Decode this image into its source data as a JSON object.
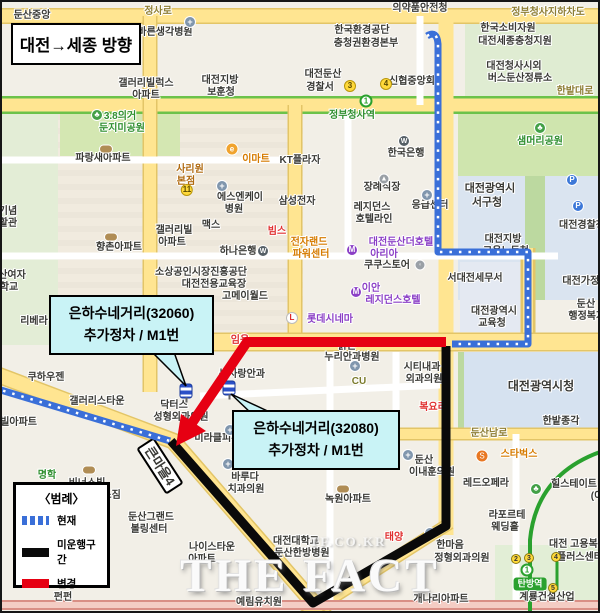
{
  "title_box": {
    "text": "대전→세종 방향"
  },
  "legend": {
    "title": "〈범례〉",
    "items": [
      {
        "label": "현재",
        "color": "#3a6fd8",
        "style": "dashed"
      },
      {
        "label": "미운행구간",
        "color": "#0a0a0a",
        "style": "solid"
      },
      {
        "label": "변경",
        "color": "#e60012",
        "style": "solid"
      }
    ]
  },
  "callouts": [
    {
      "line1": "은하수네거리(32060)",
      "line2": "추가정차 / M1번"
    },
    {
      "line1": "은하수네거리(32080)",
      "line2": "추가정차 / M1번"
    }
  ],
  "watermark": {
    "main": "THE FACT",
    "sub": "TF.CO.KR"
  },
  "routes": {
    "current_color": "#3a6fd8",
    "discontinued_color": "#0a0a0a",
    "changed_color": "#e60012"
  },
  "map": {
    "labels": [
      {
        "t": "둔산중앙",
        "x": 32,
        "y": 16,
        "w": 700
      },
      {
        "t": "정사로",
        "x": 158,
        "y": 12,
        "c": "#8d7d33"
      },
      {
        "t": "의약품안전청",
        "x": 420,
        "y": 9,
        "w": 700
      },
      {
        "t": "정부청사지하차도",
        "x": 548,
        "y": 13,
        "c": "#8d7d33"
      },
      {
        "t": "바른생각병원",
        "x": 165,
        "y": 33
      },
      {
        "t": "한국환경공단",
        "x": 362,
        "y": 31
      },
      {
        "t": "충청권환경본부",
        "x": 366,
        "y": 44
      },
      {
        "t": "한국소비자원",
        "x": 508,
        "y": 29
      },
      {
        "t": "대전세종충청지원",
        "x": 515,
        "y": 42
      },
      {
        "t": "갤러리빌럭스",
        "x": 146,
        "y": 84
      },
      {
        "t": "아파트",
        "x": 146,
        "y": 96
      },
      {
        "t": "대전지방",
        "x": 220,
        "y": 81
      },
      {
        "t": "보훈청",
        "x": 221,
        "y": 93
      },
      {
        "t": "대전둔산",
        "x": 323,
        "y": 75
      },
      {
        "t": "경찰서",
        "x": 320,
        "y": 88
      },
      {
        "t": "신협중앙회",
        "x": 412,
        "y": 82
      },
      {
        "t": "대전청사시외",
        "x": 514,
        "y": 67
      },
      {
        "t": "버스둔산정류소",
        "x": 520,
        "y": 79
      },
      {
        "t": "한밭대로",
        "x": 575,
        "y": 92,
        "c": "#8d7d33"
      },
      {
        "t": "정부청사역",
        "x": 352,
        "y": 116,
        "c": "#2f8f2f",
        "w": 700
      },
      {
        "t": "3.8의거",
        "x": 120,
        "y": 117,
        "c": "#2f8f2f"
      },
      {
        "t": "둔지미공원",
        "x": 122,
        "y": 129,
        "c": "#2f8f2f"
      },
      {
        "t": "샘머리공원",
        "x": 540,
        "y": 142,
        "c": "#2f8f2f"
      },
      {
        "t": "파랑새아파트",
        "x": 103,
        "y": 159
      },
      {
        "t": "사리원",
        "x": 190,
        "y": 170,
        "c": "#b06a10",
        "w": 700
      },
      {
        "t": "본점",
        "x": 186,
        "y": 182,
        "c": "#b06a10",
        "w": 700
      },
      {
        "t": "이마트",
        "x": 256,
        "y": 160,
        "c": "#d67b00",
        "w": 700
      },
      {
        "t": "KT플라자",
        "x": 300,
        "y": 161
      },
      {
        "t": "한국은행",
        "x": 406,
        "y": 154
      },
      {
        "t": "에스엔케이",
        "x": 240,
        "y": 198
      },
      {
        "t": "병원",
        "x": 234,
        "y": 210
      },
      {
        "t": "삼성전자",
        "x": 297,
        "y": 202
      },
      {
        "t": "빔스",
        "x": 277,
        "y": 232,
        "c": "#e03030",
        "w": 700
      },
      {
        "t": "장례식장",
        "x": 382,
        "y": 188
      },
      {
        "t": "레지던스",
        "x": 372,
        "y": 208
      },
      {
        "t": "호텔라인",
        "x": 374,
        "y": 220
      },
      {
        "t": "응급센터",
        "x": 430,
        "y": 206
      },
      {
        "t": "대전광역시",
        "x": 490,
        "y": 189,
        "s": 11
      },
      {
        "t": "서구청",
        "x": 487,
        "y": 203,
        "s": 11
      },
      {
        "t": "맥스",
        "x": 211,
        "y": 226
      },
      {
        "t": "갤러리빌",
        "x": 174,
        "y": 231
      },
      {
        "t": "아파트",
        "x": 172,
        "y": 243
      },
      {
        "t": "향촌아파트",
        "x": 119,
        "y": 248
      },
      {
        "t": "하나은행",
        "x": 238,
        "y": 252
      },
      {
        "t": "대전경찰청",
        "x": 582,
        "y": 226
      },
      {
        "t": "대전지방",
        "x": 503,
        "y": 240
      },
      {
        "t": "고용노동청",
        "x": 506,
        "y": 252
      },
      {
        "t": "전자랜드",
        "x": 309,
        "y": 243,
        "c": "#d67b00"
      },
      {
        "t": "파워센터",
        "x": 311,
        "y": 255,
        "c": "#d67b00"
      },
      {
        "t": "대전둔산더호텔",
        "x": 401,
        "y": 243,
        "c": "#8b3fc6"
      },
      {
        "t": "아리아",
        "x": 384,
        "y": 255,
        "c": "#8b3fc6"
      },
      {
        "t": "쿠쿠스토어",
        "x": 387,
        "y": 266
      },
      {
        "t": "소상공인시장진흥공단",
        "x": 201,
        "y": 273
      },
      {
        "t": "대전전용교육장",
        "x": 214,
        "y": 285
      },
      {
        "t": "고메이월드",
        "x": 245,
        "y": 297
      },
      {
        "t": "서대전세무서",
        "x": 475,
        "y": 279
      },
      {
        "t": "대전가정법원",
        "x": 590,
        "y": 282
      },
      {
        "t": "이안",
        "x": 371,
        "y": 289,
        "c": "#8b3fc6"
      },
      {
        "t": "레지던스호텔",
        "x": 393,
        "y": 301,
        "c": "#8b3fc6"
      },
      {
        "t": "둔산",
        "x": 586,
        "y": 305
      },
      {
        "t": "행정복지센터",
        "x": 596,
        "y": 317
      },
      {
        "t": "대전광역시",
        "x": 494,
        "y": 312
      },
      {
        "t": "교육청",
        "x": 492,
        "y": 324
      },
      {
        "t": "리베라",
        "x": 34,
        "y": 322
      },
      {
        "t": "롯데시네마",
        "x": 330,
        "y": 320,
        "c": "#8b3fc6"
      },
      {
        "t": "맑은",
        "x": 347,
        "y": 347
      },
      {
        "t": "누리안과병원",
        "x": 352,
        "y": 358
      },
      {
        "t": "시티내과",
        "x": 422,
        "y": 368
      },
      {
        "t": "외과의원",
        "x": 424,
        "y": 380
      },
      {
        "t": "CU",
        "x": 359,
        "y": 382,
        "c": "#7a7a2a",
        "w": 700
      },
      {
        "t": "대전광역시청",
        "x": 541,
        "y": 386,
        "s": 12,
        "w": 700
      },
      {
        "t": "눈사랑안과",
        "x": 242,
        "y": 375
      },
      {
        "t": "쿠하우젠",
        "x": 46,
        "y": 378
      },
      {
        "t": "임용",
        "x": 240,
        "y": 341,
        "c": "#e03030"
      },
      {
        "t": "복요리",
        "x": 433,
        "y": 408,
        "c": "#e03030"
      },
      {
        "t": "갤러리스타운",
        "x": 97,
        "y": 402
      },
      {
        "t": "스빌아파트",
        "x": 14,
        "y": 423
      },
      {
        "t": "닥터스",
        "x": 174,
        "y": 406
      },
      {
        "t": "성형외과의원",
        "x": 181,
        "y": 418
      },
      {
        "t": "미라클피부과",
        "x": 222,
        "y": 439
      },
      {
        "t": "비너스빌",
        "x": 87,
        "y": 484
      },
      {
        "t": "아파트",
        "x": 89,
        "y": 496
      },
      {
        "t": "명학",
        "x": 47,
        "y": 476,
        "c": "#2f8f2f"
      },
      {
        "t": "헬스짐",
        "x": 107,
        "y": 496
      },
      {
        "t": "바루다",
        "x": 245,
        "y": 478
      },
      {
        "t": "치과의원",
        "x": 246,
        "y": 490
      },
      {
        "t": "둔산그랜드",
        "x": 151,
        "y": 518
      },
      {
        "t": "볼링센터",
        "x": 149,
        "y": 530
      },
      {
        "t": "나이스타운",
        "x": 212,
        "y": 548
      },
      {
        "t": "아파트",
        "x": 202,
        "y": 560
      },
      {
        "t": "대전대학교",
        "x": 296,
        "y": 542
      },
      {
        "t": "둔산한방병원",
        "x": 302,
        "y": 554
      },
      {
        "t": "태양",
        "x": 394,
        "y": 538,
        "c": "#e03030"
      },
      {
        "t": "녹원아파트",
        "x": 348,
        "y": 500
      },
      {
        "t": "한밭종각",
        "x": 561,
        "y": 422
      },
      {
        "t": "둔산남로",
        "x": 489,
        "y": 434,
        "c": "#8d7d33"
      },
      {
        "t": "스타벅스",
        "x": 519,
        "y": 455,
        "c": "#d67b00",
        "w": 700
      },
      {
        "t": "둔산",
        "x": 424,
        "y": 461
      },
      {
        "t": "이내훈의원",
        "x": 432,
        "y": 473
      },
      {
        "t": "레드오페라",
        "x": 486,
        "y": 484
      },
      {
        "t": "힐스테이트",
        "x": 574,
        "y": 485
      },
      {
        "t": "(이",
        "x": 597,
        "y": 497
      },
      {
        "t": "라포르테",
        "x": 507,
        "y": 516
      },
      {
        "t": "웨딩홀",
        "x": 505,
        "y": 528
      },
      {
        "t": "한마음",
        "x": 450,
        "y": 546
      },
      {
        "t": "정형외과의원",
        "x": 462,
        "y": 559
      },
      {
        "t": "대전 고용복지",
        "x": 578,
        "y": 545
      },
      {
        "t": "플러스센터",
        "x": 580,
        "y": 558
      },
      {
        "t": "탄방역",
        "x": 530,
        "y": 584,
        "c": "#ffffff",
        "s": 9,
        "w": 700,
        "bg": "#2aa12e"
      },
      {
        "t": "계룡건설산업",
        "x": 547,
        "y": 598
      },
      {
        "t": "개나리아파트",
        "x": 441,
        "y": 600
      },
      {
        "t": "예림유치원",
        "x": 259,
        "y": 603
      },
      {
        "t": "펀펀",
        "x": 63,
        "y": 598
      },
      {
        "t": "기념",
        "x": 8,
        "y": 212
      },
      {
        "t": "활관",
        "x": 8,
        "y": 224
      },
      {
        "t": "산여자",
        "x": 12,
        "y": 276
      },
      {
        "t": "학교",
        "x": 9,
        "y": 288
      },
      {
        "t": "큰마을4",
        "x": 160,
        "y": 466,
        "s": 13,
        "w": 700,
        "bg": "#ffffff",
        "bd": "2px solid #000",
        "r": 57
      }
    ],
    "icons": [
      {
        "type": "hospital-cross",
        "glyph": "+",
        "x": 190,
        "y": 22
      },
      {
        "type": "hospital-cross",
        "glyph": "+",
        "x": 222,
        "y": 186
      },
      {
        "type": "hospital-cross",
        "glyph": "+",
        "x": 427,
        "y": 195
      },
      {
        "type": "hospital-cross",
        "glyph": "+",
        "x": 355,
        "y": 366
      },
      {
        "type": "hospital-cross",
        "glyph": "+",
        "x": 230,
        "y": 430
      },
      {
        "type": "hospital-cross",
        "glyph": "+",
        "x": 228,
        "y": 464
      },
      {
        "type": "hospital-cross",
        "glyph": "+",
        "x": 430,
        "y": 533
      },
      {
        "type": "hospital-cross",
        "glyph": "+",
        "x": 408,
        "y": 455
      },
      {
        "type": "bank-w",
        "glyph": "W",
        "x": 404,
        "y": 141
      },
      {
        "type": "bank-w",
        "glyph": "W",
        "x": 263,
        "y": 251
      },
      {
        "type": "park-tree",
        "glyph": "♣",
        "x": 540,
        "y": 128
      },
      {
        "type": "park-tree",
        "glyph": "♣",
        "x": 97,
        "y": 115
      },
      {
        "type": "park-tree",
        "glyph": "♣",
        "x": 536,
        "y": 489
      },
      {
        "type": "metro-badge",
        "glyph": "3",
        "x": 350,
        "y": 86
      },
      {
        "type": "metro-badge",
        "glyph": "4",
        "x": 386,
        "y": 84
      },
      {
        "type": "metro-badge",
        "glyph": "11",
        "x": 187,
        "y": 190
      },
      {
        "type": "station-badge",
        "glyph": "1",
        "x": 366,
        "y": 101
      },
      {
        "type": "parking",
        "glyph": "P",
        "x": 572,
        "y": 180
      },
      {
        "type": "parking",
        "glyph": "P",
        "x": 578,
        "y": 206
      },
      {
        "type": "emart",
        "glyph": "e",
        "x": 232,
        "y": 149
      },
      {
        "type": "starbucks",
        "glyph": "S",
        "x": 482,
        "y": 456
      },
      {
        "type": "cinema",
        "glyph": "L",
        "x": 292,
        "y": 318
      },
      {
        "type": "m-circle",
        "glyph": "M",
        "x": 356,
        "y": 292
      },
      {
        "type": "m-circle",
        "glyph": "M",
        "x": 352,
        "y": 250
      },
      {
        "type": "shop-circle",
        "glyph": "◦",
        "x": 420,
        "y": 265
      },
      {
        "type": "shop-circle",
        "glyph": "▲",
        "x": 384,
        "y": 179
      },
      {
        "type": "apt-oval",
        "glyph": "",
        "x": 106,
        "y": 149
      },
      {
        "type": "apt-oval",
        "glyph": "",
        "x": 111,
        "y": 237
      },
      {
        "type": "apt-oval",
        "glyph": "",
        "x": 343,
        "y": 489
      },
      {
        "type": "apt-oval",
        "glyph": "",
        "x": 89,
        "y": 470
      },
      {
        "type": "bus-stop",
        "glyph": "",
        "x": 186,
        "y": 391
      },
      {
        "type": "bus-stop",
        "glyph": "",
        "x": 229,
        "y": 388
      },
      {
        "type": "exit-badge",
        "glyph": "2",
        "x": 516,
        "y": 559
      },
      {
        "type": "exit-badge",
        "glyph": "3",
        "x": 529,
        "y": 558
      },
      {
        "type": "exit-badge",
        "glyph": "4",
        "x": 556,
        "y": 557
      },
      {
        "type": "exit-badge",
        "glyph": "5",
        "x": 553,
        "y": 588
      },
      {
        "type": "station-circle",
        "glyph": "1",
        "x": 527,
        "y": 570
      }
    ]
  }
}
